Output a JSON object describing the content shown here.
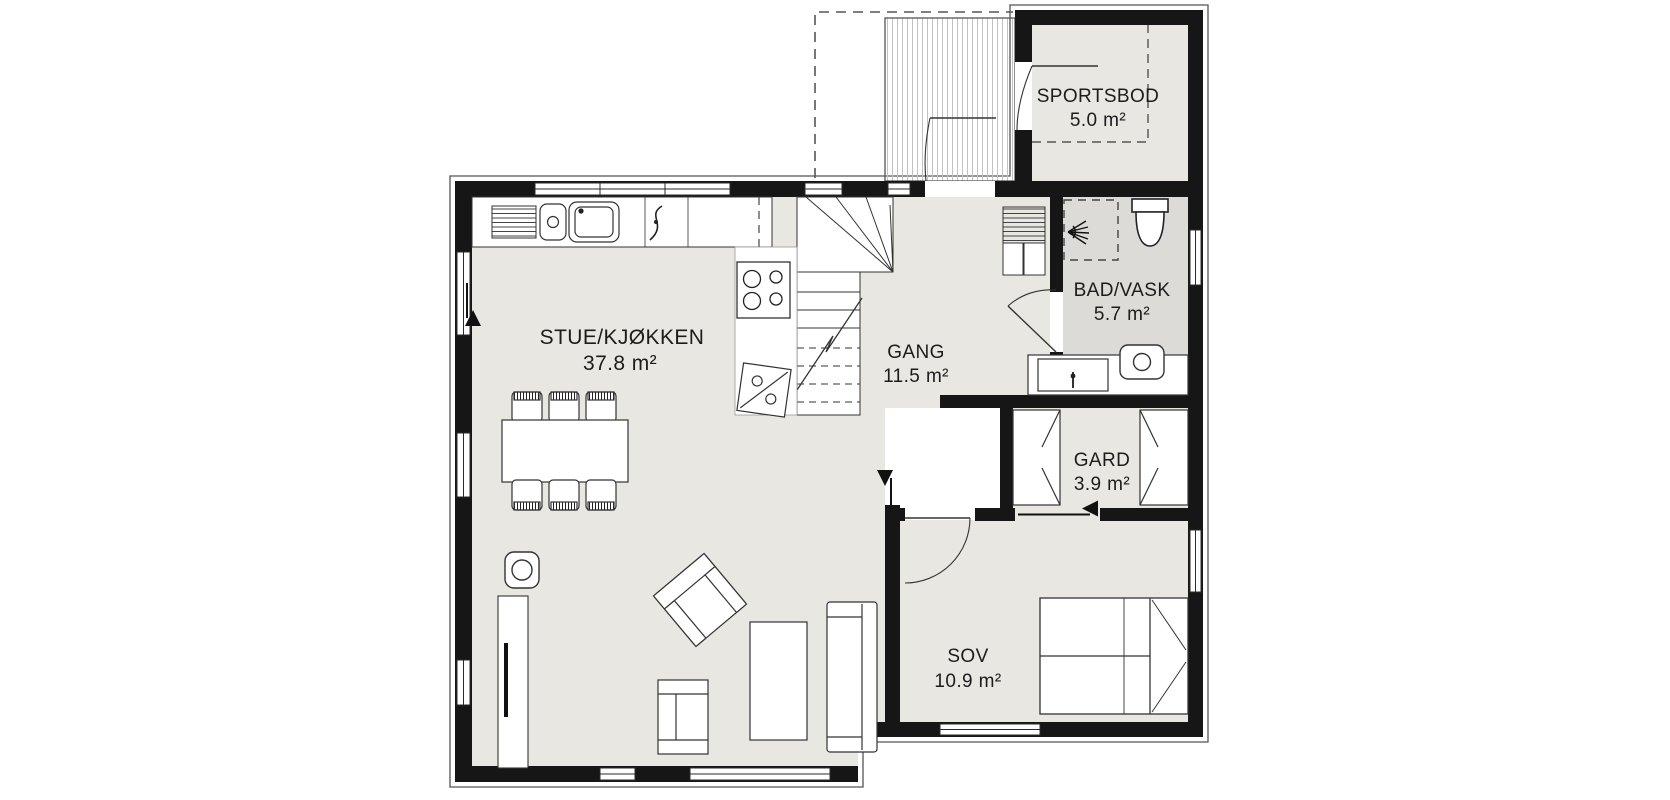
{
  "floor_plan": {
    "unit": "m²",
    "rooms": [
      {
        "id": "stue-kjokken",
        "name": "STUE/KJØKKEN",
        "area": "37.8 m²"
      },
      {
        "id": "gang",
        "name": "GANG",
        "area": "11.5 m²"
      },
      {
        "id": "bad-vask",
        "name": "BAD/VASK",
        "area": "5.7 m²"
      },
      {
        "id": "gard",
        "name": "GARD",
        "area": "3.9 m²"
      },
      {
        "id": "sov",
        "name": "SOV",
        "area": "10.9 m²"
      },
      {
        "id": "sportsbod",
        "name": "SPORTSBOD",
        "area": "5.0 m²"
      }
    ],
    "fixtures": [
      "kitchen-sink",
      "dish-drainer",
      "dishwasher-icon",
      "cooktop-icon",
      "fridge-icon",
      "staircase",
      "shower-icon",
      "toilet-icon",
      "washing-machine-icon",
      "bathroom-sink-icon",
      "vent-shaft",
      "wardrobe-left",
      "wardrobe-right",
      "double-bed",
      "sofa",
      "coffee-table",
      "armchair",
      "armchair-angled",
      "dining-table",
      "dining-chairs",
      "wood-stove-icon",
      "tv-bench",
      "porch-deck",
      "entrance-door",
      "sportsbod-door",
      "bathroom-door",
      "bedroom-door",
      "passage-arrow-up",
      "passage-arrow-right",
      "exterior-arrow"
    ],
    "colors": {
      "wall": "#161616",
      "floor": "#e9e7e2",
      "floor_bath": "#dcdbd8",
      "floor_white": "#ffffff",
      "line": "#333333",
      "deck_stripe": "#c2c2c2",
      "background": "#ffffff"
    }
  }
}
